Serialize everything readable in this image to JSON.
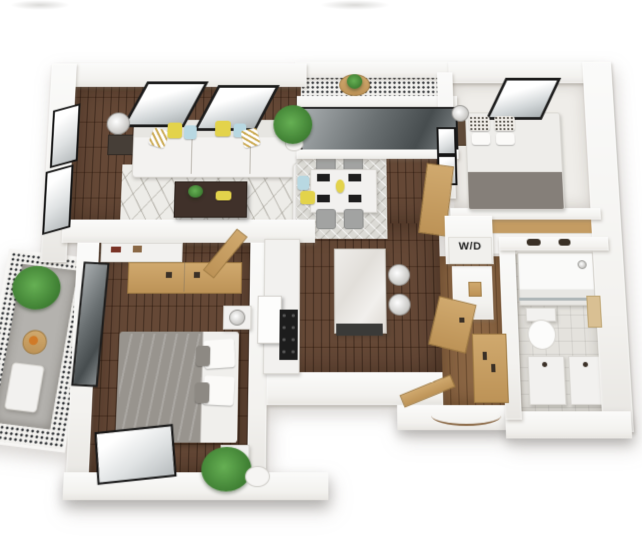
{
  "image": {
    "kind": "3d-isometric-floor-plan",
    "description": "Bird's-eye 3D render of a one/two-bedroom apartment floor plan",
    "width_px": 642,
    "height_px": 550
  },
  "labels": {
    "washer_dryer": "W/D"
  },
  "palette": {
    "background": "#ffffff",
    "wall_white": "#f8f8f6",
    "wood_floor": "#5d3f2c",
    "hall_wood": "#8a6543",
    "bath_tile": "#e4e2dd",
    "balcony_mosaic": "#23262a",
    "sofa_white": "#f2f1ee",
    "accent_yellow": "#e3d34b",
    "accent_blue": "#b8d8e2",
    "plant_green": "#4c9440",
    "bed_grey": "#97938d",
    "wood_trim": "#c49e66",
    "glass_dark": "#6a7072",
    "frame_black": "#1c1c1c"
  },
  "rooms": [
    {
      "name": "living-room",
      "furniture": [
        "sofa",
        "accent-pillows",
        "area-rug",
        "coffee-table",
        "armchair",
        "floor-lamp",
        "side-table",
        "two-skylight-windows",
        "two-side-windows",
        "potted-plant"
      ]
    },
    {
      "name": "dining-area",
      "furniture": [
        "dining-table",
        "four-chairs",
        "diamond-rug",
        "place-settings"
      ]
    },
    {
      "name": "top-balcony",
      "furniture": [
        "mosaic-floor",
        "bistro-table",
        "plant",
        "sliding-glass-doors"
      ]
    },
    {
      "name": "bedroom-2",
      "furniture": [
        "queen-bed",
        "patterned-pillows",
        "nightstand",
        "sphere-lamp",
        "skylight-window",
        "shoe-closet"
      ]
    },
    {
      "name": "kitchen",
      "furniture": [
        "island-with-marble-top",
        "two-bar-stools",
        "black-range",
        "white-counter",
        "appliance"
      ]
    },
    {
      "name": "laundry-closet",
      "furniture": [
        "stacked-washer-dryer"
      ]
    },
    {
      "name": "hallway",
      "furniture": [
        "wood-wardrobe",
        "open-wood-door",
        "entry-door-with-swing-arc"
      ]
    },
    {
      "name": "bathroom",
      "furniture": [
        "glass-shower",
        "toilet",
        "double-vanity",
        "towel"
      ]
    },
    {
      "name": "master-bedroom",
      "furniture": [
        "grey-bed",
        "two-nightstands",
        "sphere-lamps",
        "dresser",
        "wood-closet-doors",
        "potted-plant",
        "corner-window",
        "balcony-glass-door"
      ]
    },
    {
      "name": "side-balcony",
      "furniture": [
        "mosaic-floor",
        "plant",
        "lounge-chair",
        "small-table"
      ]
    }
  ]
}
